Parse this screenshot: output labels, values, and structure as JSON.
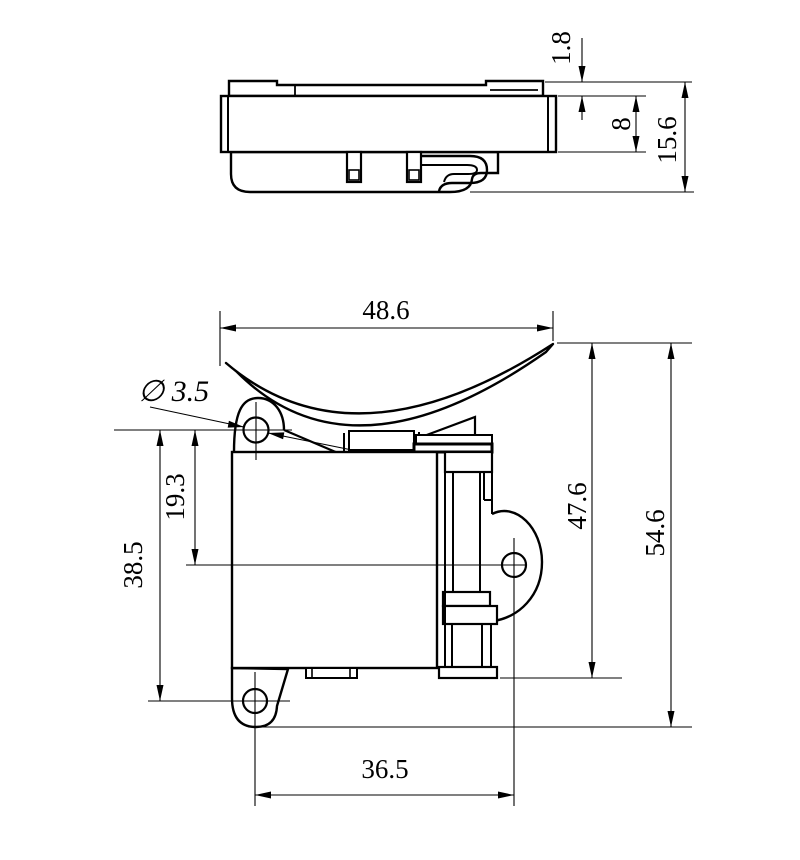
{
  "drawing": {
    "type": "two-view mechanical part drawing",
    "views": {
      "top": "side profile view",
      "front": "front saddle-clamp view"
    },
    "colors": {
      "line": "#000000",
      "background": "#ffffff"
    },
    "dimensions": {
      "plate_thickness": "1.8",
      "body_height": "8",
      "profile_total_height": "15.6",
      "saddle_width": "48.6",
      "hole_diameter_label": "∅ 3.5",
      "upper_hole_to_centerline": "19.3",
      "upper_to_lower_hole": "38.5",
      "right_section_height": "47.6",
      "front_total_height": "54.6",
      "hole_horizontal_spacing": "36.5"
    }
  }
}
